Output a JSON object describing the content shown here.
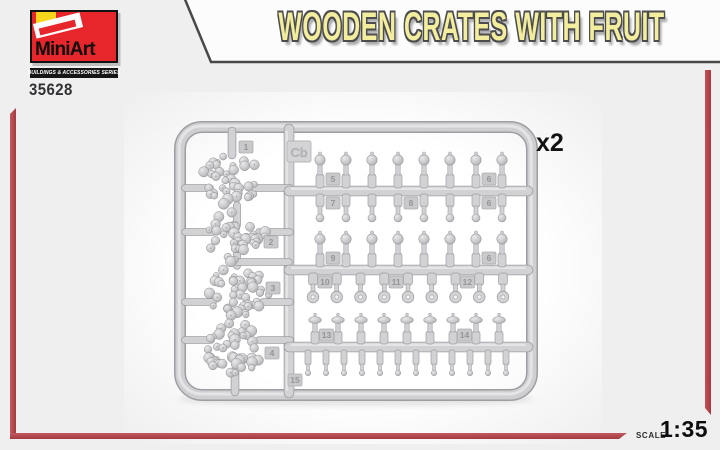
{
  "brand": {
    "name": "MiniArt",
    "series": "BUILDINGS & ACCESSORIES SERIES",
    "product_code": "35628"
  },
  "title": "WOODEN CRATES WITH FRUIT",
  "multiplier": "x2",
  "scale": {
    "label": "SCALE",
    "value": "1:35"
  },
  "colors": {
    "accent_red": "#a43a40",
    "logo_red": "#e7262b",
    "logo_yellow": "#f6d51b",
    "title_yellow": "#f3ed9e",
    "sprue_gray": "#d2d2d5"
  },
  "sprue": {
    "code": "Cb",
    "fruit_clusters": [
      {
        "part": "1"
      },
      {
        "part": "2"
      },
      {
        "part": "3"
      },
      {
        "part": "4"
      }
    ],
    "rails": [
      {
        "upper": {
          "count": 8,
          "type": "ball-top",
          "tags": [
            {
              "label": "5",
              "slot": 0
            },
            {
              "label": "6",
              "slot": 6
            }
          ]
        },
        "lower": {
          "count": 8,
          "type": "ball-bottom",
          "tags": [
            {
              "label": "7",
              "slot": 0
            },
            {
              "label": "8",
              "slot": 3
            },
            {
              "label": "6",
              "slot": 6
            }
          ]
        }
      },
      {
        "upper": {
          "count": 8,
          "type": "ball-top",
          "tags": [
            {
              "label": "9",
              "slot": 0
            },
            {
              "label": "6",
              "slot": 6
            }
          ]
        },
        "lower": {
          "count": 9,
          "type": "ring-bottom",
          "tags": [
            {
              "label": "10",
              "slot": 0
            },
            {
              "label": "11",
              "slot": 3
            },
            {
              "label": "12",
              "slot": 6
            }
          ]
        }
      },
      {
        "upper": {
          "count": 9,
          "type": "cap-top",
          "tags": [
            {
              "label": "13",
              "slot": 0
            },
            {
              "label": "14",
              "slot": 6
            }
          ]
        },
        "lower": {
          "count": 12,
          "type": "small-peg",
          "tags": []
        }
      }
    ],
    "bottom_tag": "15"
  }
}
